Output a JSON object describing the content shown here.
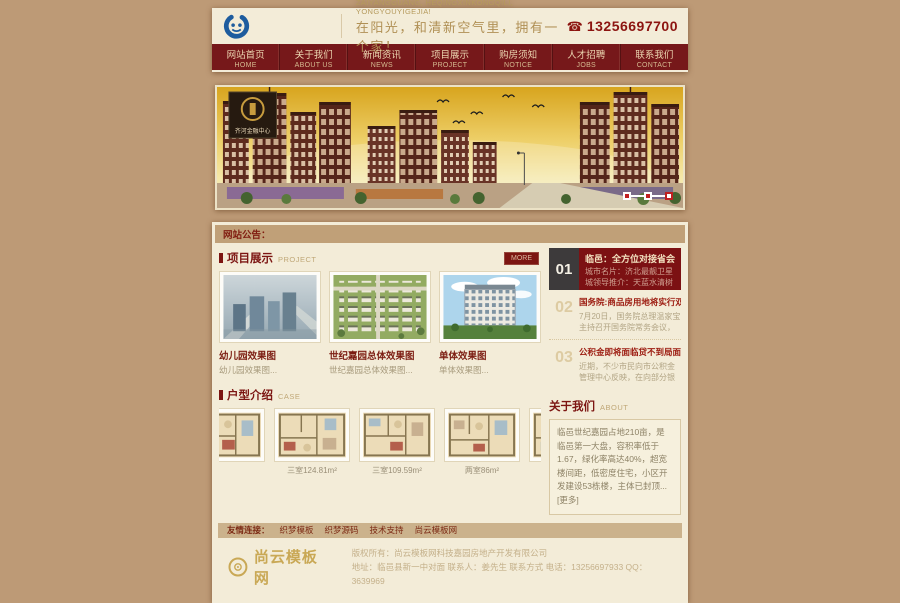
{
  "colors": {
    "accent_dark_red": "#7c1512",
    "nav_bg": "#76181a",
    "page_tan": "#bd9a76",
    "panel_cream": "#f3ecd8",
    "notice_tan": "#c0a078",
    "logo_blue": "#1e5c9e",
    "gold": "#c9a855"
  },
  "header": {
    "slogan_en": "ZAIYANGGUANG, HEQINGXINKONGQILI, YONGYOUYIGEJIA!",
    "slogan_cn": "在阳光，和清新空气里，拥有一个家！",
    "phone_icon": "☎",
    "phone": "13256697700"
  },
  "nav": {
    "items": [
      {
        "cn": "网站首页",
        "en": "HOME"
      },
      {
        "cn": "关于我们",
        "en": "ABOUT US"
      },
      {
        "cn": "新闻资讯",
        "en": "NEWS"
      },
      {
        "cn": "项目展示",
        "en": "PROJECT"
      },
      {
        "cn": "购房须知",
        "en": "NOTICE"
      },
      {
        "cn": "人才招聘",
        "en": "JOBS"
      },
      {
        "cn": "联系我们",
        "en": "CONTACT"
      }
    ]
  },
  "banner": {
    "badge": "齐河金融中心"
  },
  "announcement": {
    "label": "网站公告："
  },
  "project": {
    "title": "项目展示",
    "subtitle": "PROJECT",
    "more": "MORE",
    "cards": [
      {
        "title": "幼儿园效果图",
        "desc": "幼儿园效果图..."
      },
      {
        "title": "世纪嘉园总体效果图",
        "desc": "世纪嘉园总体效果图..."
      },
      {
        "title": "单体效果图",
        "desc": "单体效果图..."
      }
    ]
  },
  "news": {
    "items": [
      {
        "num": "01",
        "title": "临邑：全方位对接省会经济圈",
        "snippet": "城市名片：济北最靓卫星城领导推介：天蓝水清树绿，宜商..."
      },
      {
        "num": "02",
        "title": "国务院:商品房用地将实行双轨",
        "snippet": "7月20日，国务院总理温家宝主持召开国务院常务会议，研究..."
      },
      {
        "num": "03",
        "title": "公积金即将面临贷不到局面",
        "snippet": "近期，不少市民向市公积金管理中心反映，在向部分银行申..."
      }
    ]
  },
  "case": {
    "title": "户型介绍",
    "subtitle": "CASE",
    "plans": [
      {
        "caption": ""
      },
      {
        "caption": "三室124.81m²"
      },
      {
        "caption": "三室109.59m²"
      },
      {
        "caption": "两室86m²"
      },
      {
        "caption": "两室95.."
      }
    ]
  },
  "about": {
    "title": "关于我们",
    "subtitle": "ABOUT",
    "text": "临邑世纪嘉园占地210亩，是临邑第一大盘，容积率低于1.67，绿化率高达40%，超宽楼间距，低密度住宅，小区开发建设53栋楼，主体已封顶...",
    "more": "[更多]"
  },
  "links": {
    "label": "友情连接：",
    "items": [
      "织梦模板",
      "织梦源码",
      "技术支持",
      "尚云模板网"
    ]
  },
  "footer": {
    "site_name": "尚云模板网",
    "line1": "版权所有：尚云模板网科技嘉园房地产开发有限公司",
    "line2": "地址：临邑县新一中对面 联系人：姜先生 联系方式 电话：13256697933 QQ：3639969"
  }
}
